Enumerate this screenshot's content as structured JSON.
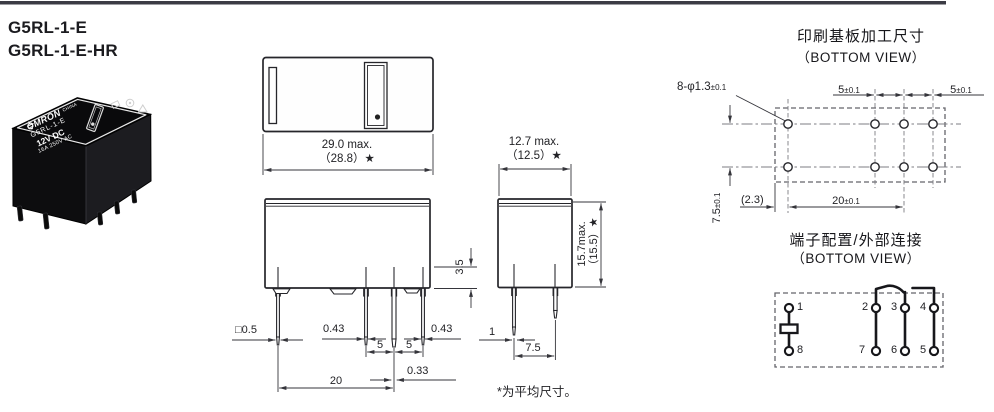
{
  "header": {
    "rule_color": "#3b3b44",
    "models": {
      "model1": "G5RL-1-E",
      "model2": "G5RL-1-E-HR"
    }
  },
  "photo": {
    "brand": "OMRON",
    "origin": "CHINA",
    "model": "G5RL-1-E",
    "coil_voltage": "12V DC",
    "contact_rating": "16A 250V AC"
  },
  "top_view": {
    "width_max": "29.0 max.",
    "width_avg": "（28.8）★"
  },
  "front_view": {
    "coil_pin_size": "□0.5",
    "pin_width_left": "0.43",
    "pin_width_right": "0.43",
    "pin_pitch_a": "5",
    "pin_pitch_b": "5",
    "center_pin_width": "0.33",
    "row_span": "20",
    "standoff_height": "3.5"
  },
  "side_view": {
    "depth_max": "12.7 max.",
    "depth_avg": "（12.5）★",
    "height_max": "15.7max.",
    "height_avg": "（15.5）★",
    "pin_thickness": "1",
    "pin_row_pitch": "7.5"
  },
  "footnote": "*为平均尺寸。",
  "pcb_view": {
    "title": "印刷基板加工尺寸",
    "subtitle": "（BOTTOM VIEW）",
    "hole_callout": "8-φ1.3",
    "hole_callout_tol": "±0.1",
    "dim_5_left": "5",
    "dim_5_left_tol": "±0.1",
    "dim_5_right": "5",
    "dim_5_right_tol": "±0.1",
    "dim_75": "7.5",
    "dim_75_tol": "±0.1",
    "dim_23": "(2.3)",
    "dim_20": "20",
    "dim_20_tol": "±0.1"
  },
  "terminal_view": {
    "title": "端子配置/外部连接",
    "subtitle": "（BOTTOM VIEW）",
    "pins": {
      "p1": "1",
      "p2": "2",
      "p3": "3",
      "p4": "4",
      "p5": "5",
      "p6": "6",
      "p7": "7",
      "p8": "8"
    }
  }
}
